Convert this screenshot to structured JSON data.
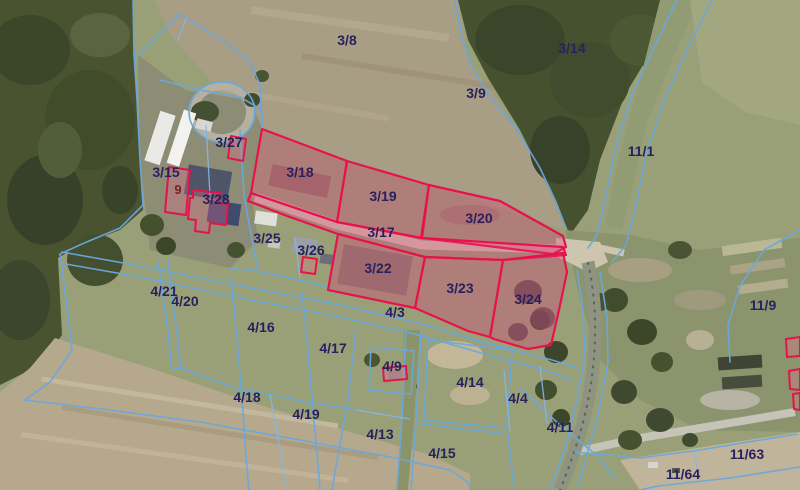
{
  "map": {
    "description": "cadastral-parcel-map-over-aerial-imagery",
    "colors": {
      "label": "#29215e",
      "building_label": "#7b1e28",
      "boundary_line": "#69a8dc",
      "highlight_stroke": "#e6134b",
      "highlight_fill": "rgba(225,55,120,0.32)",
      "building_stroke": "#e6134b",
      "building_fill": "rgba(235,110,145,0.30)"
    },
    "labels": [
      {
        "text": "3/8",
        "x": 347,
        "y": 40
      },
      {
        "text": "3/14",
        "x": 572,
        "y": 48
      },
      {
        "text": "3/9",
        "x": 476,
        "y": 93
      },
      {
        "text": "11/1",
        "x": 641,
        "y": 151
      },
      {
        "text": "3/27",
        "x": 229,
        "y": 142
      },
      {
        "text": "3/15",
        "x": 166,
        "y": 172
      },
      {
        "text": "3/18",
        "x": 300,
        "y": 172
      },
      {
        "text": "9",
        "x": 178,
        "y": 189,
        "kind": "building"
      },
      {
        "text": "3/19",
        "x": 383,
        "y": 196
      },
      {
        "text": "3/28",
        "x": 216,
        "y": 199
      },
      {
        "text": "3/20",
        "x": 479,
        "y": 218
      },
      {
        "text": "3/17",
        "x": 381,
        "y": 232
      },
      {
        "text": "3/25",
        "x": 267,
        "y": 238
      },
      {
        "text": "3/26",
        "x": 311,
        "y": 250
      },
      {
        "text": "3/22",
        "x": 378,
        "y": 268
      },
      {
        "text": "3/23",
        "x": 460,
        "y": 288
      },
      {
        "text": "3/24",
        "x": 528,
        "y": 299
      },
      {
        "text": "4/21",
        "x": 164,
        "y": 291
      },
      {
        "text": "4/20",
        "x": 185,
        "y": 301
      },
      {
        "text": "11/9",
        "x": 763,
        "y": 305
      },
      {
        "text": "4/3",
        "x": 395,
        "y": 312
      },
      {
        "text": "4/16",
        "x": 261,
        "y": 327
      },
      {
        "text": "4/17",
        "x": 333,
        "y": 348
      },
      {
        "text": "4/9",
        "x": 392,
        "y": 366
      },
      {
        "text": "4/14",
        "x": 470,
        "y": 382
      },
      {
        "text": "4/18",
        "x": 247,
        "y": 397
      },
      {
        "text": "4/4",
        "x": 518,
        "y": 398
      },
      {
        "text": "4/19",
        "x": 306,
        "y": 414
      },
      {
        "text": "4/11",
        "x": 560,
        "y": 427
      },
      {
        "text": "4/13",
        "x": 380,
        "y": 434
      },
      {
        "text": "4/15",
        "x": 442,
        "y": 453
      },
      {
        "text": "11/63",
        "x": 747,
        "y": 454
      },
      {
        "text": "11/64",
        "x": 683,
        "y": 474
      }
    ],
    "highlighted_parcels": [
      {
        "id": "3/18",
        "points": "262,129 347,161 337,222 251,193"
      },
      {
        "id": "3/19",
        "points": "347,161 429,185 421,238 337,222"
      },
      {
        "id": "3/20",
        "points": "429,185 500,201 563,236 566,247 553,254 422,238"
      },
      {
        "id": "3/17",
        "points": "251,193 337,222 422,238 563,247 566,255 503,260 425,257 338,234 287,216 248,201"
      },
      {
        "id": "3/22",
        "points": "338,234 425,257 415,308 328,290"
      },
      {
        "id": "3/23",
        "points": "425,257 503,260 490,337 468,331 415,308"
      },
      {
        "id": "3/24",
        "points": "503,260 563,253 567,272 559,310 551,345 528,349 494,339 490,337"
      }
    ],
    "building_outlines": [
      {
        "id": "building-9",
        "points": "169,167 190,170 186,215 165,212"
      },
      {
        "id": "building-3-27",
        "points": "231,136 246,139 243,161 228,158"
      },
      {
        "id": "building-3-28",
        "points": "193,190 220,193 219,203 228,204 226,225 210,223 209,233 195,231 196,220 188,219 190,198 193,198"
      },
      {
        "id": "building-3-26",
        "points": "303,257 317,259 315,274 301,272"
      },
      {
        "id": "building-4-9",
        "points": "383,368 406,366 407,379 384,381"
      },
      {
        "id": "building-east-1",
        "points": "786,339 800,337 800,356 787,357"
      },
      {
        "id": "building-east-2",
        "points": "789,371 800,369 800,390 790,389"
      },
      {
        "id": "building-east-3",
        "points": "793,394 800,393 800,410 794,409"
      }
    ]
  }
}
